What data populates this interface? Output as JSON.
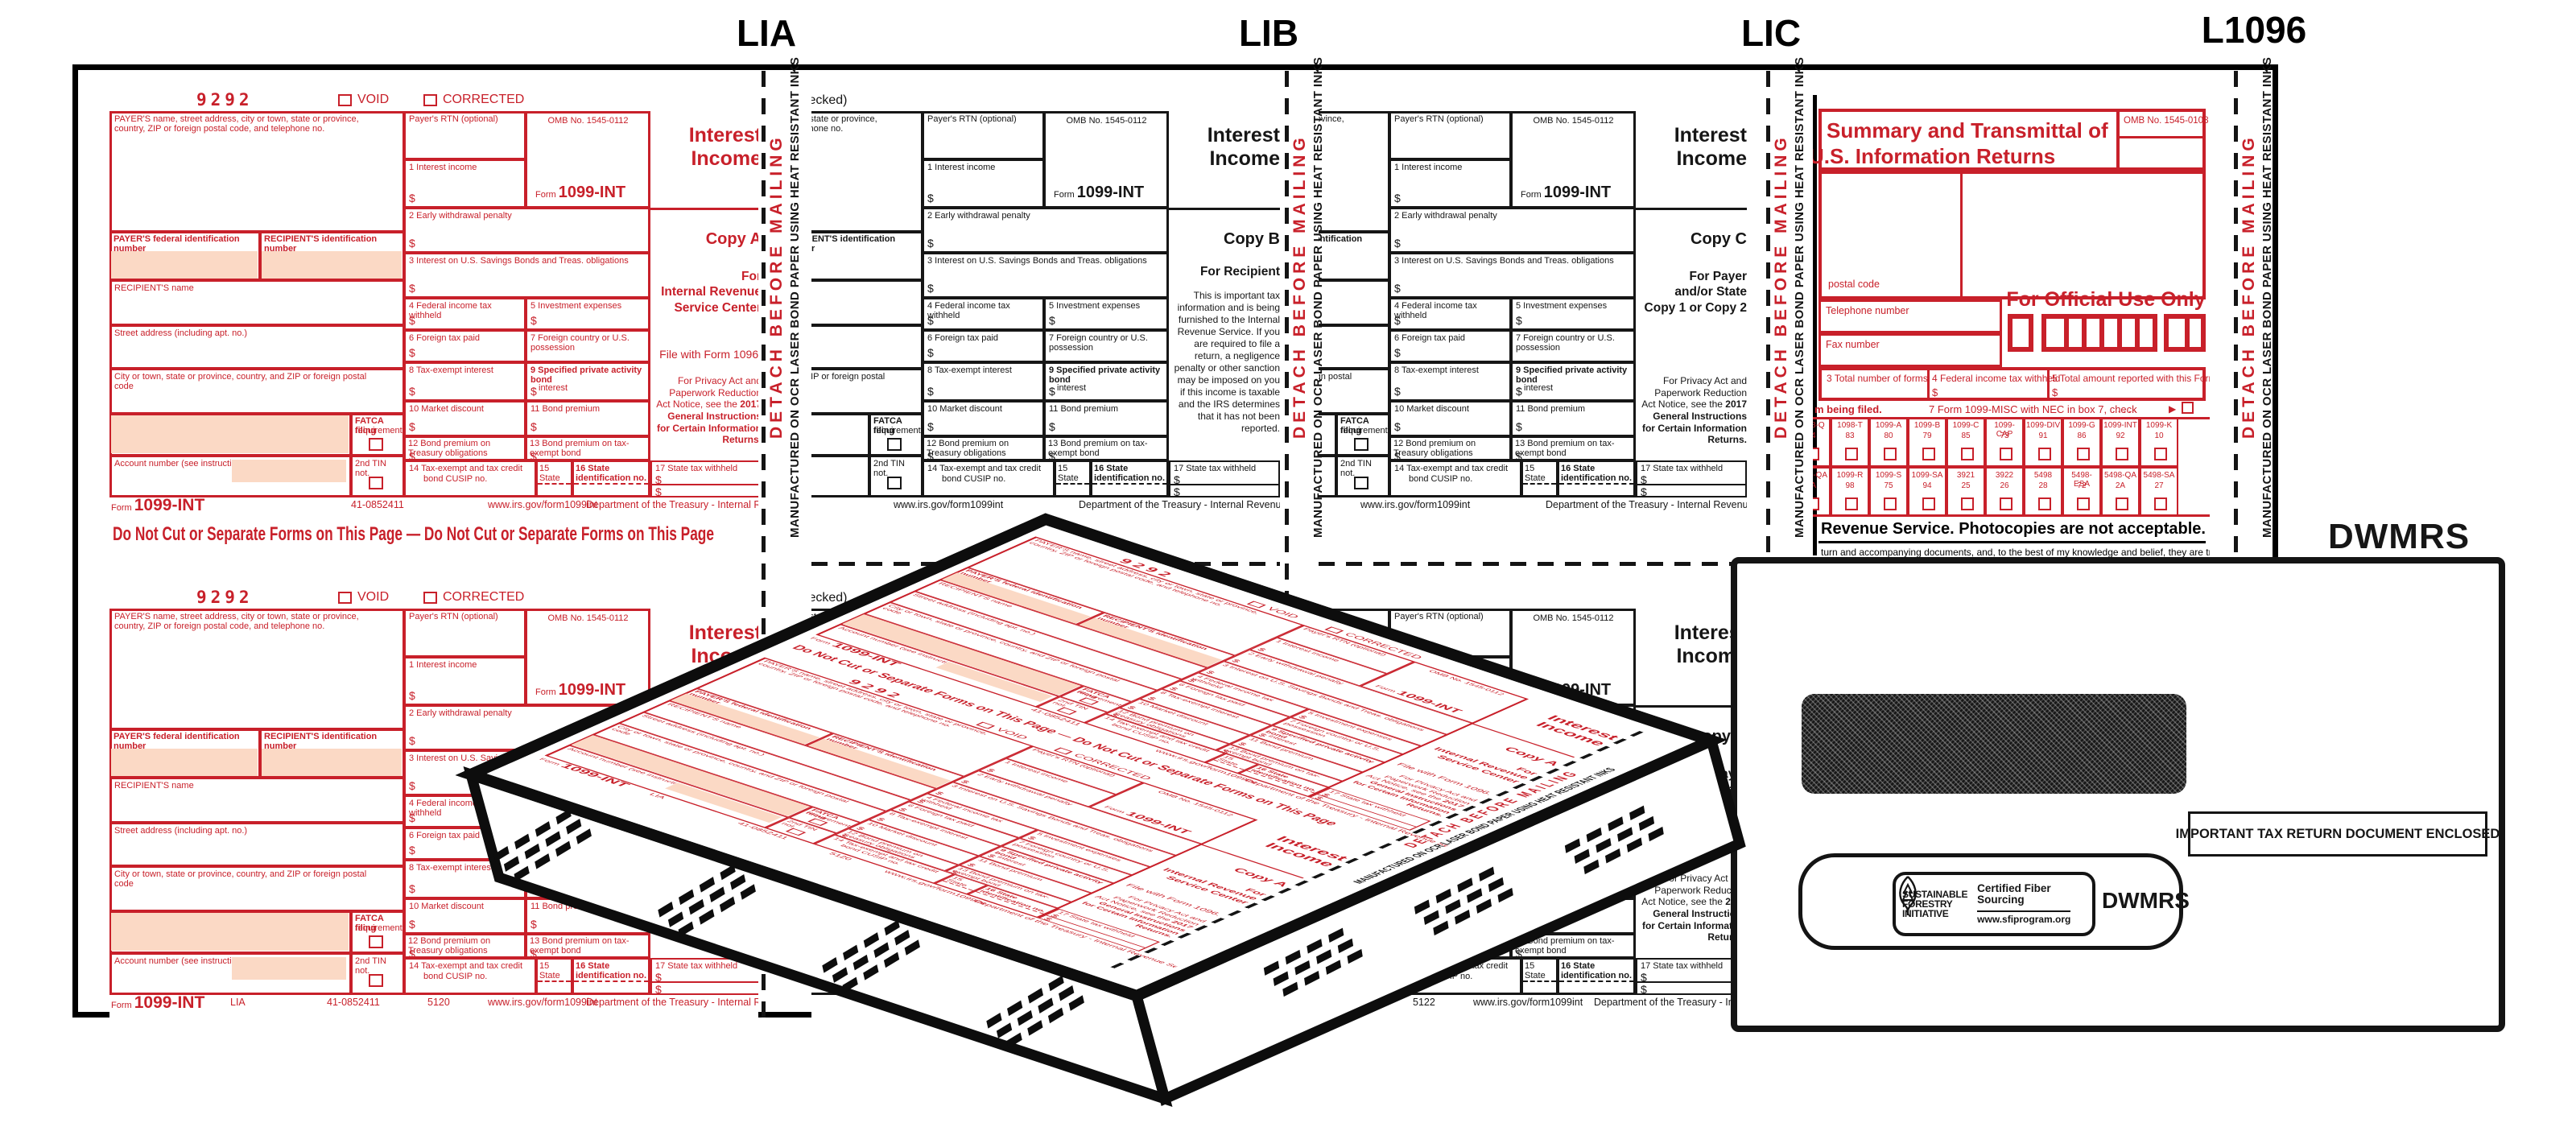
{
  "page": {
    "sheet_labels": [
      "LIA",
      "LIB",
      "LIC",
      "L1096"
    ],
    "dwmrs_label": "DWMRS"
  },
  "strip": {
    "detach": "DETACH BEFORE MAILING",
    "manufactured": "MANUFACTURED ON OCR LASER BOND PAPER USING HEAT RESISTANT INKS"
  },
  "form1099": {
    "code": "9292",
    "void_label": "VOID",
    "corrected_label": "CORRECTED",
    "corrected_if_label": "CORRECTED (if checked)",
    "fields": {
      "payer_block": "PAYER'S name, street address, city or town, state or province, country, ZIP or foreign postal code, and telephone no.",
      "payer_rtn": "Payer's RTN (optional)",
      "omb": "OMB No. 1545-0112",
      "payer_fed": "PAYER'S federal identification number",
      "recipient_id": "RECIPIENT'S identification number",
      "recipient_name": "RECIPIENT'S name",
      "street": "Street address (including apt. no.)",
      "city": "City or town, state or province, country, and ZIP or foreign postal code",
      "fatca_1": "FATCA filing",
      "fatca_2": "requirement",
      "account": "Account number (see instructions)",
      "second_tin": "2nd TIN not.",
      "b1": "1 Interest income",
      "b2": "2 Early withdrawal penalty",
      "b3": "3 Interest on U.S. Savings Bonds and Treas. obligations",
      "b4": "4 Federal income tax withheld",
      "b5": "5 Investment expenses",
      "b6": "6 Foreign tax paid",
      "b7": "7 Foreign country or U.S. possession",
      "b8": "8 Tax-exempt interest",
      "b9_1": "9 Specified private activity bond",
      "b9_2": "interest",
      "b10": "10 Market discount",
      "b11": "11 Bond premium",
      "b12": "12 Bond premium on Treasury obligations",
      "b13": "13 Bond premium on tax-exempt bond",
      "b14_1": "14 Tax-exempt and tax credit",
      "b14_2": "bond CUSIP no.",
      "b15": "15 State",
      "b16": "16 State identification no.",
      "b17": "17 State tax withheld",
      "dollar": "$"
    },
    "title_lines": [
      "Interest",
      "Income"
    ],
    "form_word": "Form",
    "form_number": "1099-INT",
    "copies": {
      "A": {
        "copy": "Copy A",
        "for_lines": [
          "For",
          "Internal Revenue",
          "Service Center"
        ],
        "file_with": "File with Form 1096.",
        "privacy": "For Privacy Act and Paperwork Reduction Act Notice, see the",
        "privacy_bold": "2017 General Instructions for Certain Information Returns."
      },
      "B": {
        "copy": "Copy B",
        "for_lines": [
          "For Recipient"
        ],
        "note": "This is important tax information and is being furnished to the Internal Revenue Service. If you are required to file a return, a negligence penalty or other sanction may be imposed on you if this income is taxable and the IRS determines that it has not been reported."
      },
      "C": {
        "copy": "Copy C",
        "for_lines": [
          "For Payer",
          "and/or State",
          "Copy 1 or Copy 2"
        ],
        "privacy": "For Privacy Act and Paperwork Reduction Act Notice, see the",
        "privacy_bold": "2017 General Instructions for Certain Information Returns."
      }
    },
    "footer": {
      "form_word": "Form",
      "form_number": "1099-INT",
      "cat_no": "41-0852411",
      "sheet_code": "LIA",
      "page_code_1": "5120",
      "page_code_2": "5122",
      "url": "www.irs.gov/form1099int",
      "dept": "Department of the Treasury - Internal Revenue Service"
    },
    "do_not_cut": "Do Not Cut or Separate Forms on This Page  —  Do Not Cut or Separate Forms on This Page"
  },
  "f1096": {
    "title_1": "Summary and Transmittal of",
    "title_2": "U.S. Information Returns",
    "omb": "OMB No. 1545-0108",
    "postal": "postal code",
    "telephone": "Telephone number",
    "fax": "Fax number",
    "official": "For Official Use Only",
    "b3": "3 Total number of forms",
    "b4": "4 Federal income tax withheld",
    "b5": "5 Total amount reported with this Form 1096",
    "being_filed": "m being filed.",
    "b7": "7 Form 1099-MISC with NEC in box 7, check",
    "b7_dots": ".   .   .   .   .",
    "b7_arrow": "▶",
    "grid_row1": [
      [
        "1098-Q",
        "74"
      ],
      [
        "1098-T",
        "83"
      ],
      [
        "1099-A",
        "80"
      ],
      [
        "1099-B",
        "79"
      ],
      [
        "1099-C",
        "85"
      ],
      [
        "1099-CAP",
        "73"
      ],
      [
        "1099-DIV",
        "91"
      ],
      [
        "1099-G",
        "86"
      ],
      [
        "1099-INT",
        "92"
      ],
      [
        "1099-K",
        "10"
      ]
    ],
    "grid_row2": [
      [
        "1099-QA",
        "1A"
      ],
      [
        "1099-R",
        "98"
      ],
      [
        "1099-S",
        "75"
      ],
      [
        "1099-SA",
        "94"
      ],
      [
        "3921",
        "25"
      ],
      [
        "3922",
        "26"
      ],
      [
        "5498",
        "28"
      ],
      [
        "5498-ESA",
        "72"
      ],
      [
        "5498-QA",
        "2A"
      ],
      [
        "5498-SA",
        "27"
      ]
    ],
    "photocopies": "Revenue Service. Photocopies are not acceptable.",
    "declaration": "turn and accompanying documents, and, to the best of my knowledge and belief, they are true, correct,",
    "dollar": "$"
  },
  "envelope": {
    "important": "IMPORTANT TAX RETURN DOCUMENT ENCLOSED",
    "sfi_lines": [
      "SUSTAINABLE",
      "FORESTRY",
      "INITIATIVE"
    ],
    "cert_1": "Certified Fiber",
    "cert_2": "Sourcing",
    "sfi_url": "www.sfiprogram.org",
    "dwmrs": "DWMRS"
  },
  "colors": {
    "form_red": "#c8202a",
    "shade_pink": "#fbd9c5",
    "ink_black": "#161616"
  }
}
